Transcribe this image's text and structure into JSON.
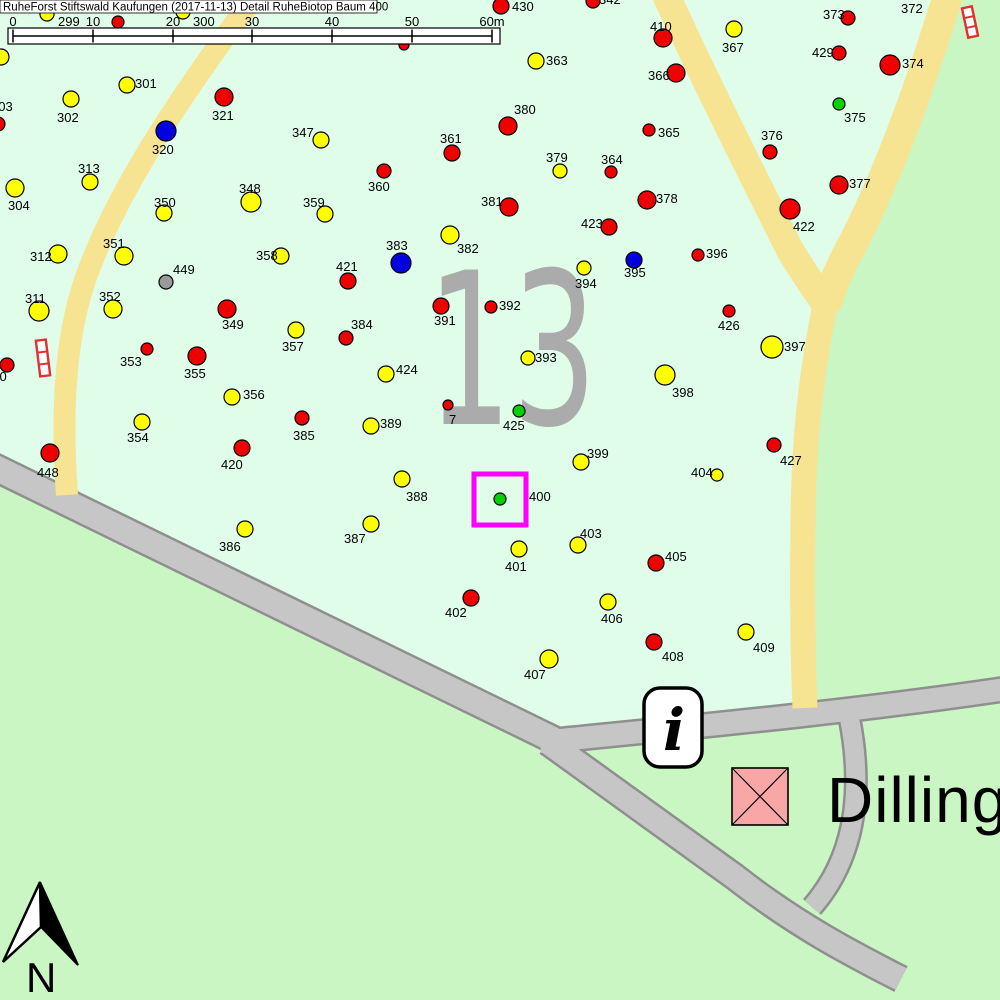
{
  "title": "RuheForst Stiftswald Kaufungen (2017-11-13) Detail  RuheBiotop Baum 400",
  "map": {
    "compartment_label": "13",
    "highlighted_tree": "400"
  },
  "compass": {
    "north_label": "N"
  },
  "icons": {
    "info": "i"
  },
  "place": {
    "name": "Dillingh"
  },
  "scale": {
    "unit_suffix": "m",
    "ticks": [
      {
        "label": "0",
        "x": 13
      },
      {
        "label": "10",
        "x": 93
      },
      {
        "label": "20",
        "x": 173
      },
      {
        "label": "30",
        "x": 252
      },
      {
        "label": "40",
        "x": 332
      },
      {
        "label": "50",
        "x": 412
      },
      {
        "label": "60m",
        "x": 492
      }
    ]
  },
  "colors": {
    "forest": "#DFFDE9",
    "meadow": "#C9F6C2",
    "road_fill": "#C6C6C6",
    "road_edge": "#8F8F8F",
    "path_yellow": "#F7E492",
    "red": "#EE0000",
    "yellow": "#FFFF00",
    "blue": "#0000E0",
    "green": "#00D200",
    "gray": "#9A9A9A",
    "magenta": "#FF00FF",
    "pink": "#F9A6A6",
    "big_number_gray": "#ABABAB"
  },
  "special_markers": [
    {
      "name": "striped-marker-top-right",
      "x": 970,
      "y": 22,
      "h": 30,
      "angle": -12
    },
    {
      "name": "striped-marker-left",
      "x": 43,
      "y": 358,
      "h": 36,
      "angle": -7
    }
  ],
  "points": [
    {
      "id": "299",
      "c": "yellow",
      "x": 47,
      "y": 14,
      "r": 7,
      "lx": 58,
      "ly": 15
    },
    {
      "id": "300",
      "c": "yellow",
      "x": 183,
      "y": 12,
      "r": 7,
      "lx": 193,
      "ly": 15
    },
    {
      "id": "",
      "c": "red",
      "x": 118,
      "y": 22,
      "r": 6,
      "lx": 0,
      "ly": 0
    },
    {
      "id": "",
      "c": "red",
      "x": 404,
      "y": 45,
      "r": 5,
      "lx": 0,
      "ly": 0
    },
    {
      "id": "",
      "c": "red",
      "x": -2,
      "y": 124,
      "r": 7,
      "lx": 0,
      "ly": 0
    },
    {
      "id": "303",
      "c": "yellow",
      "x": 1,
      "y": 57,
      "r": 8,
      "lx": -9,
      "ly": 100
    },
    {
      "id": "430",
      "c": "red",
      "x": 501,
      "y": 6,
      "r": 8,
      "lx": 512,
      "ly": 0
    },
    {
      "id": "342",
      "c": "red",
      "x": 593,
      "y": 1,
      "r": 7,
      "lx": 599,
      "ly": -7
    },
    {
      "id": "410",
      "c": "red",
      "x": 663,
      "y": 38,
      "r": 9,
      "lx": 650,
      "ly": 20
    },
    {
      "id": "367",
      "c": "yellow",
      "x": 734,
      "y": 29,
      "r": 8,
      "lx": 722,
      "ly": 41
    },
    {
      "id": "373",
      "c": "red",
      "x": 848,
      "y": 18,
      "r": 7,
      "lx": 823,
      "ly": 8
    },
    {
      "id": "372",
      "c": "yellow",
      "x": 921,
      "y": -9,
      "r": 7,
      "lx": 901,
      "ly": 2
    },
    {
      "id": "429",
      "c": "red",
      "x": 839,
      "y": 53,
      "r": 7,
      "lx": 812,
      "ly": 46
    },
    {
      "id": "374",
      "c": "red",
      "x": 890,
      "y": 65,
      "r": 10,
      "lx": 902,
      "ly": 57
    },
    {
      "id": "363",
      "c": "yellow",
      "x": 536,
      "y": 61,
      "r": 8,
      "lx": 546,
      "ly": 54
    },
    {
      "id": "366",
      "c": "red",
      "x": 676,
      "y": 73,
      "r": 9,
      "lx": 648,
      "ly": 69
    },
    {
      "id": "301",
      "c": "yellow",
      "x": 127,
      "y": 85,
      "r": 8,
      "lx": 135,
      "ly": 77
    },
    {
      "id": "302",
      "c": "yellow",
      "x": 71,
      "y": 99,
      "r": 8,
      "lx": 57,
      "ly": 111
    },
    {
      "id": "321",
      "c": "red",
      "x": 224,
      "y": 97,
      "r": 9,
      "lx": 212,
      "ly": 109
    },
    {
      "id": "320",
      "c": "blue",
      "x": 166,
      "y": 131,
      "r": 10,
      "lx": 152,
      "ly": 143
    },
    {
      "id": "375",
      "c": "green",
      "x": 839,
      "y": 104,
      "r": 6,
      "lx": 844,
      "ly": 111
    },
    {
      "id": "380",
      "c": "red",
      "x": 508,
      "y": 126,
      "r": 9,
      "lx": 514,
      "ly": 103
    },
    {
      "id": "365",
      "c": "red",
      "x": 649,
      "y": 130,
      "r": 6,
      "lx": 658,
      "ly": 126
    },
    {
      "id": "376",
      "c": "red",
      "x": 770,
      "y": 152,
      "r": 7,
      "lx": 761,
      "ly": 129
    },
    {
      "id": "347",
      "c": "yellow",
      "x": 321,
      "y": 140,
      "r": 8,
      "lx": 292,
      "ly": 126
    },
    {
      "id": "361",
      "c": "red",
      "x": 452,
      "y": 153,
      "r": 8,
      "lx": 440,
      "ly": 132
    },
    {
      "id": "364",
      "c": "red",
      "x": 611,
      "y": 172,
      "r": 6,
      "lx": 601,
      "ly": 153
    },
    {
      "id": "379",
      "c": "yellow",
      "x": 560,
      "y": 171,
      "r": 7,
      "lx": 546,
      "ly": 151
    },
    {
      "id": "313",
      "c": "yellow",
      "x": 90,
      "y": 182,
      "r": 8,
      "lx": 78,
      "ly": 162
    },
    {
      "id": "360",
      "c": "red",
      "x": 384,
      "y": 171,
      "r": 7,
      "lx": 368,
      "ly": 180
    },
    {
      "id": "377",
      "c": "red",
      "x": 839,
      "y": 185,
      "r": 9,
      "lx": 849,
      "ly": 177
    },
    {
      "id": "348",
      "c": "yellow",
      "x": 251,
      "y": 202,
      "r": 10,
      "lx": 239,
      "ly": 182
    },
    {
      "id": "350",
      "c": "yellow",
      "x": 164,
      "y": 213,
      "r": 8,
      "lx": 154,
      "ly": 196
    },
    {
      "id": "359",
      "c": "yellow",
      "x": 325,
      "y": 214,
      "r": 8,
      "lx": 303,
      "ly": 196
    },
    {
      "id": "381",
      "c": "red",
      "x": 509,
      "y": 207,
      "r": 9,
      "lx": 481,
      "ly": 195
    },
    {
      "id": "378",
      "c": "red",
      "x": 647,
      "y": 200,
      "r": 9,
      "lx": 656,
      "ly": 192
    },
    {
      "id": "423",
      "c": "red",
      "x": 609,
      "y": 227,
      "r": 8,
      "lx": 581,
      "ly": 217
    },
    {
      "id": "422",
      "c": "red",
      "x": 790,
      "y": 209,
      "r": 10,
      "lx": 793,
      "ly": 220
    },
    {
      "id": "304",
      "c": "yellow",
      "x": 15,
      "y": 188,
      "r": 9,
      "lx": 8,
      "ly": 199
    },
    {
      "id": "312",
      "c": "yellow",
      "x": 58,
      "y": 254,
      "r": 9,
      "lx": 30,
      "ly": 250
    },
    {
      "id": "351",
      "c": "yellow",
      "x": 124,
      "y": 256,
      "r": 9,
      "lx": 103,
      "ly": 237
    },
    {
      "id": "358",
      "c": "yellow",
      "x": 281,
      "y": 256,
      "r": 8,
      "lx": 256,
      "ly": 249
    },
    {
      "id": "382",
      "c": "yellow",
      "x": 450,
      "y": 235,
      "r": 9,
      "lx": 457,
      "ly": 242
    },
    {
      "id": "383",
      "c": "blue",
      "x": 401,
      "y": 263,
      "r": 10,
      "lx": 386,
      "ly": 239
    },
    {
      "id": "421",
      "c": "red",
      "x": 348,
      "y": 281,
      "r": 8,
      "lx": 336,
      "ly": 260
    },
    {
      "id": "394",
      "c": "yellow",
      "x": 584,
      "y": 268,
      "r": 7,
      "lx": 575,
      "ly": 277
    },
    {
      "id": "395",
      "c": "blue",
      "x": 634,
      "y": 260,
      "r": 8,
      "lx": 624,
      "ly": 266
    },
    {
      "id": "396",
      "c": "red",
      "x": 698,
      "y": 255,
      "r": 6,
      "lx": 706,
      "ly": 247
    },
    {
      "id": "449",
      "c": "gray",
      "x": 166,
      "y": 282,
      "r": 7,
      "lx": 173,
      "ly": 263
    },
    {
      "id": "311",
      "c": "yellow",
      "x": 39,
      "y": 311,
      "r": 10,
      "lx": 25,
      "ly": 292
    },
    {
      "id": "352",
      "c": "yellow",
      "x": 113,
      "y": 309,
      "r": 9,
      "lx": 99,
      "ly": 290
    },
    {
      "id": "349",
      "c": "red",
      "x": 227,
      "y": 309,
      "r": 9,
      "lx": 222,
      "ly": 318
    },
    {
      "id": "391",
      "c": "red",
      "x": 441,
      "y": 306,
      "r": 8,
      "lx": 434,
      "ly": 314
    },
    {
      "id": "392",
      "c": "red",
      "x": 491,
      "y": 307,
      "r": 6,
      "lx": 499,
      "ly": 299
    },
    {
      "id": "426",
      "c": "red",
      "x": 729,
      "y": 311,
      "r": 6,
      "lx": 718,
      "ly": 319
    },
    {
      "id": "357",
      "c": "yellow",
      "x": 296,
      "y": 330,
      "r": 8,
      "lx": 282,
      "ly": 340
    },
    {
      "id": "384",
      "c": "red",
      "x": 346,
      "y": 338,
      "r": 7,
      "lx": 351,
      "ly": 318
    },
    {
      "id": "397",
      "c": "yellow",
      "x": 772,
      "y": 347,
      "r": 11,
      "lx": 784,
      "ly": 340
    },
    {
      "id": "353",
      "c": "red",
      "x": 147,
      "y": 349,
      "r": 6,
      "lx": 120,
      "ly": 355
    },
    {
      "id": "355",
      "c": "red",
      "x": 197,
      "y": 356,
      "r": 9,
      "lx": 184,
      "ly": 367
    },
    {
      "id": "393",
      "c": "yellow",
      "x": 528,
      "y": 358,
      "r": 7,
      "lx": 535,
      "ly": 351
    },
    {
      "id": "398",
      "c": "yellow",
      "x": 665,
      "y": 375,
      "r": 10,
      "lx": 672,
      "ly": 386
    },
    {
      "id": "310",
      "c": "red",
      "x": 7,
      "y": 365,
      "r": 7,
      "lx": -15,
      "ly": 370
    },
    {
      "id": "448",
      "c": "red",
      "x": 50,
      "y": 453,
      "r": 9,
      "lx": 37,
      "ly": 466
    },
    {
      "id": "356",
      "c": "yellow",
      "x": 232,
      "y": 397,
      "r": 8,
      "lx": 243,
      "ly": 388
    },
    {
      "id": "424",
      "c": "yellow",
      "x": 386,
      "y": 374,
      "r": 8,
      "lx": 396,
      "ly": 363
    },
    {
      "id": "7",
      "c": "red",
      "x": 448,
      "y": 405,
      "r": 5,
      "lx": 449,
      "ly": 413
    },
    {
      "id": "425",
      "c": "green",
      "x": 519,
      "y": 411,
      "r": 6,
      "lx": 503,
      "ly": 419
    },
    {
      "id": "354",
      "c": "yellow",
      "x": 142,
      "y": 422,
      "r": 8,
      "lx": 127,
      "ly": 431
    },
    {
      "id": "385",
      "c": "red",
      "x": 302,
      "y": 418,
      "r": 7,
      "lx": 293,
      "ly": 429
    },
    {
      "id": "389",
      "c": "yellow",
      "x": 371,
      "y": 426,
      "r": 8,
      "lx": 380,
      "ly": 417
    },
    {
      "id": "420",
      "c": "red",
      "x": 242,
      "y": 448,
      "r": 8,
      "lx": 221,
      "ly": 458
    },
    {
      "id": "399",
      "c": "yellow",
      "x": 581,
      "y": 462,
      "r": 8,
      "lx": 587,
      "ly": 447
    },
    {
      "id": "427",
      "c": "red",
      "x": 774,
      "y": 445,
      "r": 7,
      "lx": 780,
      "ly": 454
    },
    {
      "id": "404",
      "c": "yellow",
      "x": 717,
      "y": 475,
      "r": 6,
      "lx": 691,
      "ly": 466
    },
    {
      "id": "388",
      "c": "yellow",
      "x": 402,
      "y": 479,
      "r": 8,
      "lx": 406,
      "ly": 490
    },
    {
      "id": "400",
      "c": "green",
      "x": 500,
      "y": 499,
      "r": 6,
      "lx": 529,
      "ly": 490
    },
    {
      "id": "386",
      "c": "yellow",
      "x": 245,
      "y": 529,
      "r": 8,
      "lx": 219,
      "ly": 540
    },
    {
      "id": "387",
      "c": "yellow",
      "x": 371,
      "y": 524,
      "r": 8,
      "lx": 344,
      "ly": 532
    },
    {
      "id": "403",
      "c": "yellow",
      "x": 578,
      "y": 545,
      "r": 8,
      "lx": 580,
      "ly": 527
    },
    {
      "id": "401",
      "c": "yellow",
      "x": 519,
      "y": 549,
      "r": 8,
      "lx": 505,
      "ly": 560
    },
    {
      "id": "405",
      "c": "red",
      "x": 656,
      "y": 563,
      "r": 8,
      "lx": 665,
      "ly": 550
    },
    {
      "id": "402",
      "c": "red",
      "x": 471,
      "y": 598,
      "r": 8,
      "lx": 445,
      "ly": 606
    },
    {
      "id": "406",
      "c": "yellow",
      "x": 608,
      "y": 602,
      "r": 8,
      "lx": 601,
      "ly": 612
    },
    {
      "id": "408",
      "c": "red",
      "x": 654,
      "y": 642,
      "r": 8,
      "lx": 662,
      "ly": 650
    },
    {
      "id": "407",
      "c": "yellow",
      "x": 549,
      "y": 659,
      "r": 9,
      "lx": 524,
      "ly": 668
    },
    {
      "id": "409",
      "c": "yellow",
      "x": 746,
      "y": 632,
      "r": 8,
      "lx": 753,
      "ly": 641
    }
  ]
}
